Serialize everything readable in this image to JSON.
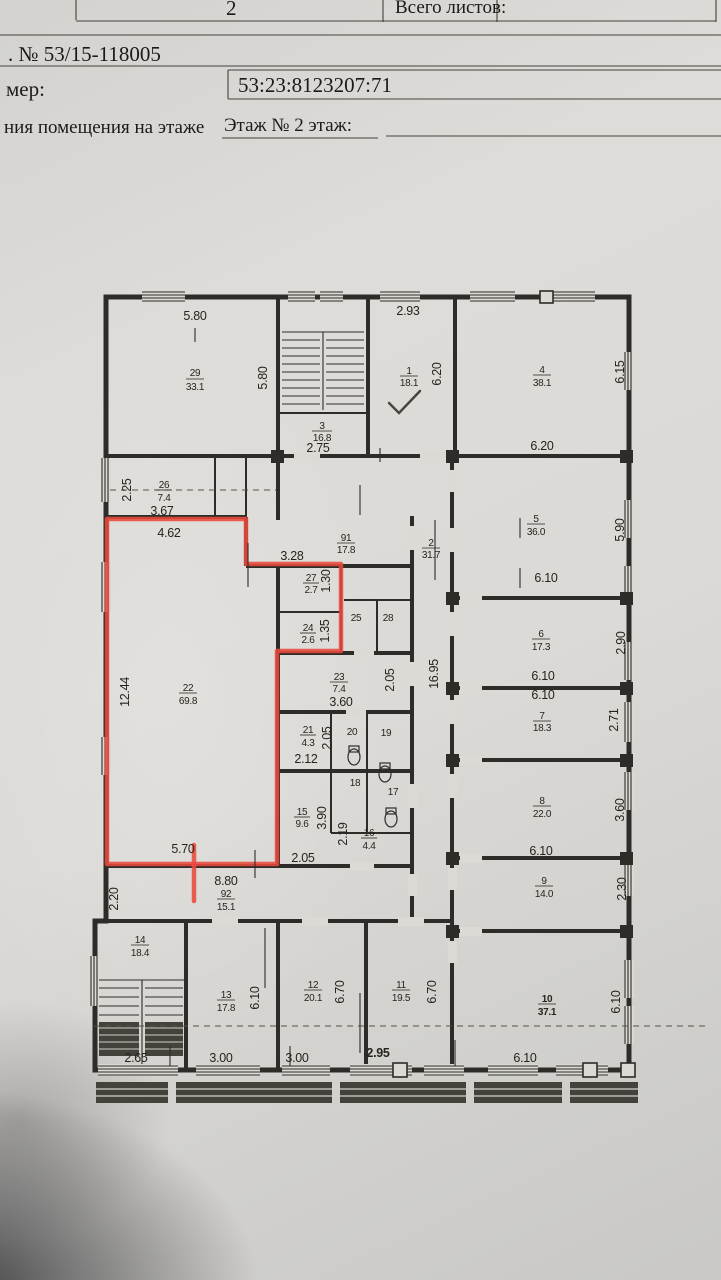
{
  "header": {
    "page_number": "2",
    "total_sheets_label": "Всего листов:",
    "doc_number": ". № 53/15-118005",
    "field_label": "мер:",
    "cadastral_number": "53:23:8123207:71",
    "caption": "ния помещения на этаже",
    "caption_value": "Этаж № 2 этаж:"
  },
  "plan": {
    "rooms": {
      "r1": {
        "num": "1",
        "area": "18.1"
      },
      "r2": {
        "num": "2",
        "area": "31.7"
      },
      "r3": {
        "num": "3",
        "area": "16.8"
      },
      "r4": {
        "num": "4",
        "area": "38.1"
      },
      "r5": {
        "num": "5",
        "area": "36.0"
      },
      "r6": {
        "num": "6",
        "area": "17.3"
      },
      "r7": {
        "num": "7",
        "area": "18.3"
      },
      "r8": {
        "num": "8",
        "area": "22.0"
      },
      "r9": {
        "num": "9",
        "area": "14.0"
      },
      "r10": {
        "num": "10",
        "area": "37.1"
      },
      "r11": {
        "num": "11",
        "area": "19.5"
      },
      "r12": {
        "num": "12",
        "area": "20.1"
      },
      "r13": {
        "num": "13",
        "area": "17.8"
      },
      "r14": {
        "num": "14",
        "area": "18.4"
      },
      "r15": {
        "num": "15",
        "area": "9.6"
      },
      "r16": {
        "num": "16",
        "area": "4.4"
      },
      "r17": {
        "num": "17"
      },
      "r18": {
        "num": "18"
      },
      "r19": {
        "num": "19"
      },
      "r20": {
        "num": "20"
      },
      "r21": {
        "num": "21",
        "area": "4.3"
      },
      "r22": {
        "num": "22",
        "area": "69.8"
      },
      "r23": {
        "num": "23",
        "area": "7.4"
      },
      "r24": {
        "num": "24",
        "area": "2.6"
      },
      "r25": {
        "num": "25"
      },
      "r26": {
        "num": "26",
        "area": "7.4"
      },
      "r27": {
        "num": "27",
        "area": "2.7"
      },
      "r28": {
        "num": "28"
      },
      "r29": {
        "num": "29",
        "area": "33.1"
      },
      "r91": {
        "num": "91",
        "area": "17.8"
      },
      "r92": {
        "num": "92",
        "area": "15.1"
      }
    },
    "dims": {
      "d_580a": "5.80",
      "d_580b": "5.80",
      "d_293": "2.93",
      "d_620a": "6.20",
      "d_615": "6.15",
      "d_275": "2.75",
      "d_620b": "6.20",
      "d_225": "2.25",
      "d_367": "3.67",
      "d_462": "4.62",
      "d_328": "3.28",
      "d_130": "1.30",
      "d_135": "1.35",
      "d_590": "5.90",
      "d_610a": "6.10",
      "d_290": "2.90",
      "d_1244": "12.44",
      "d_360a": "3.60",
      "d_205a": "2.05",
      "d_1695": "16.95",
      "d_610b": "6.10",
      "d_610c": "6.10",
      "d_205b": "2.05",
      "d_212": "2.12",
      "d_271": "2.71",
      "d_390": "3.90",
      "d_219": "2.19",
      "d_360b": "3.60",
      "d_610d": "6.10",
      "d_570": "5.70",
      "d_205c": "2.05",
      "d_880": "8.80",
      "d_230": "2.30",
      "d_220": "2.20",
      "d_610e": "6.10",
      "d_670a": "6.70",
      "d_670b": "6.70",
      "d_610f": "6.10",
      "d_265": "2.65",
      "d_300a": "3.00",
      "d_300b": "3.00",
      "d_295": "2.95",
      "d_610g": "6.10"
    }
  }
}
